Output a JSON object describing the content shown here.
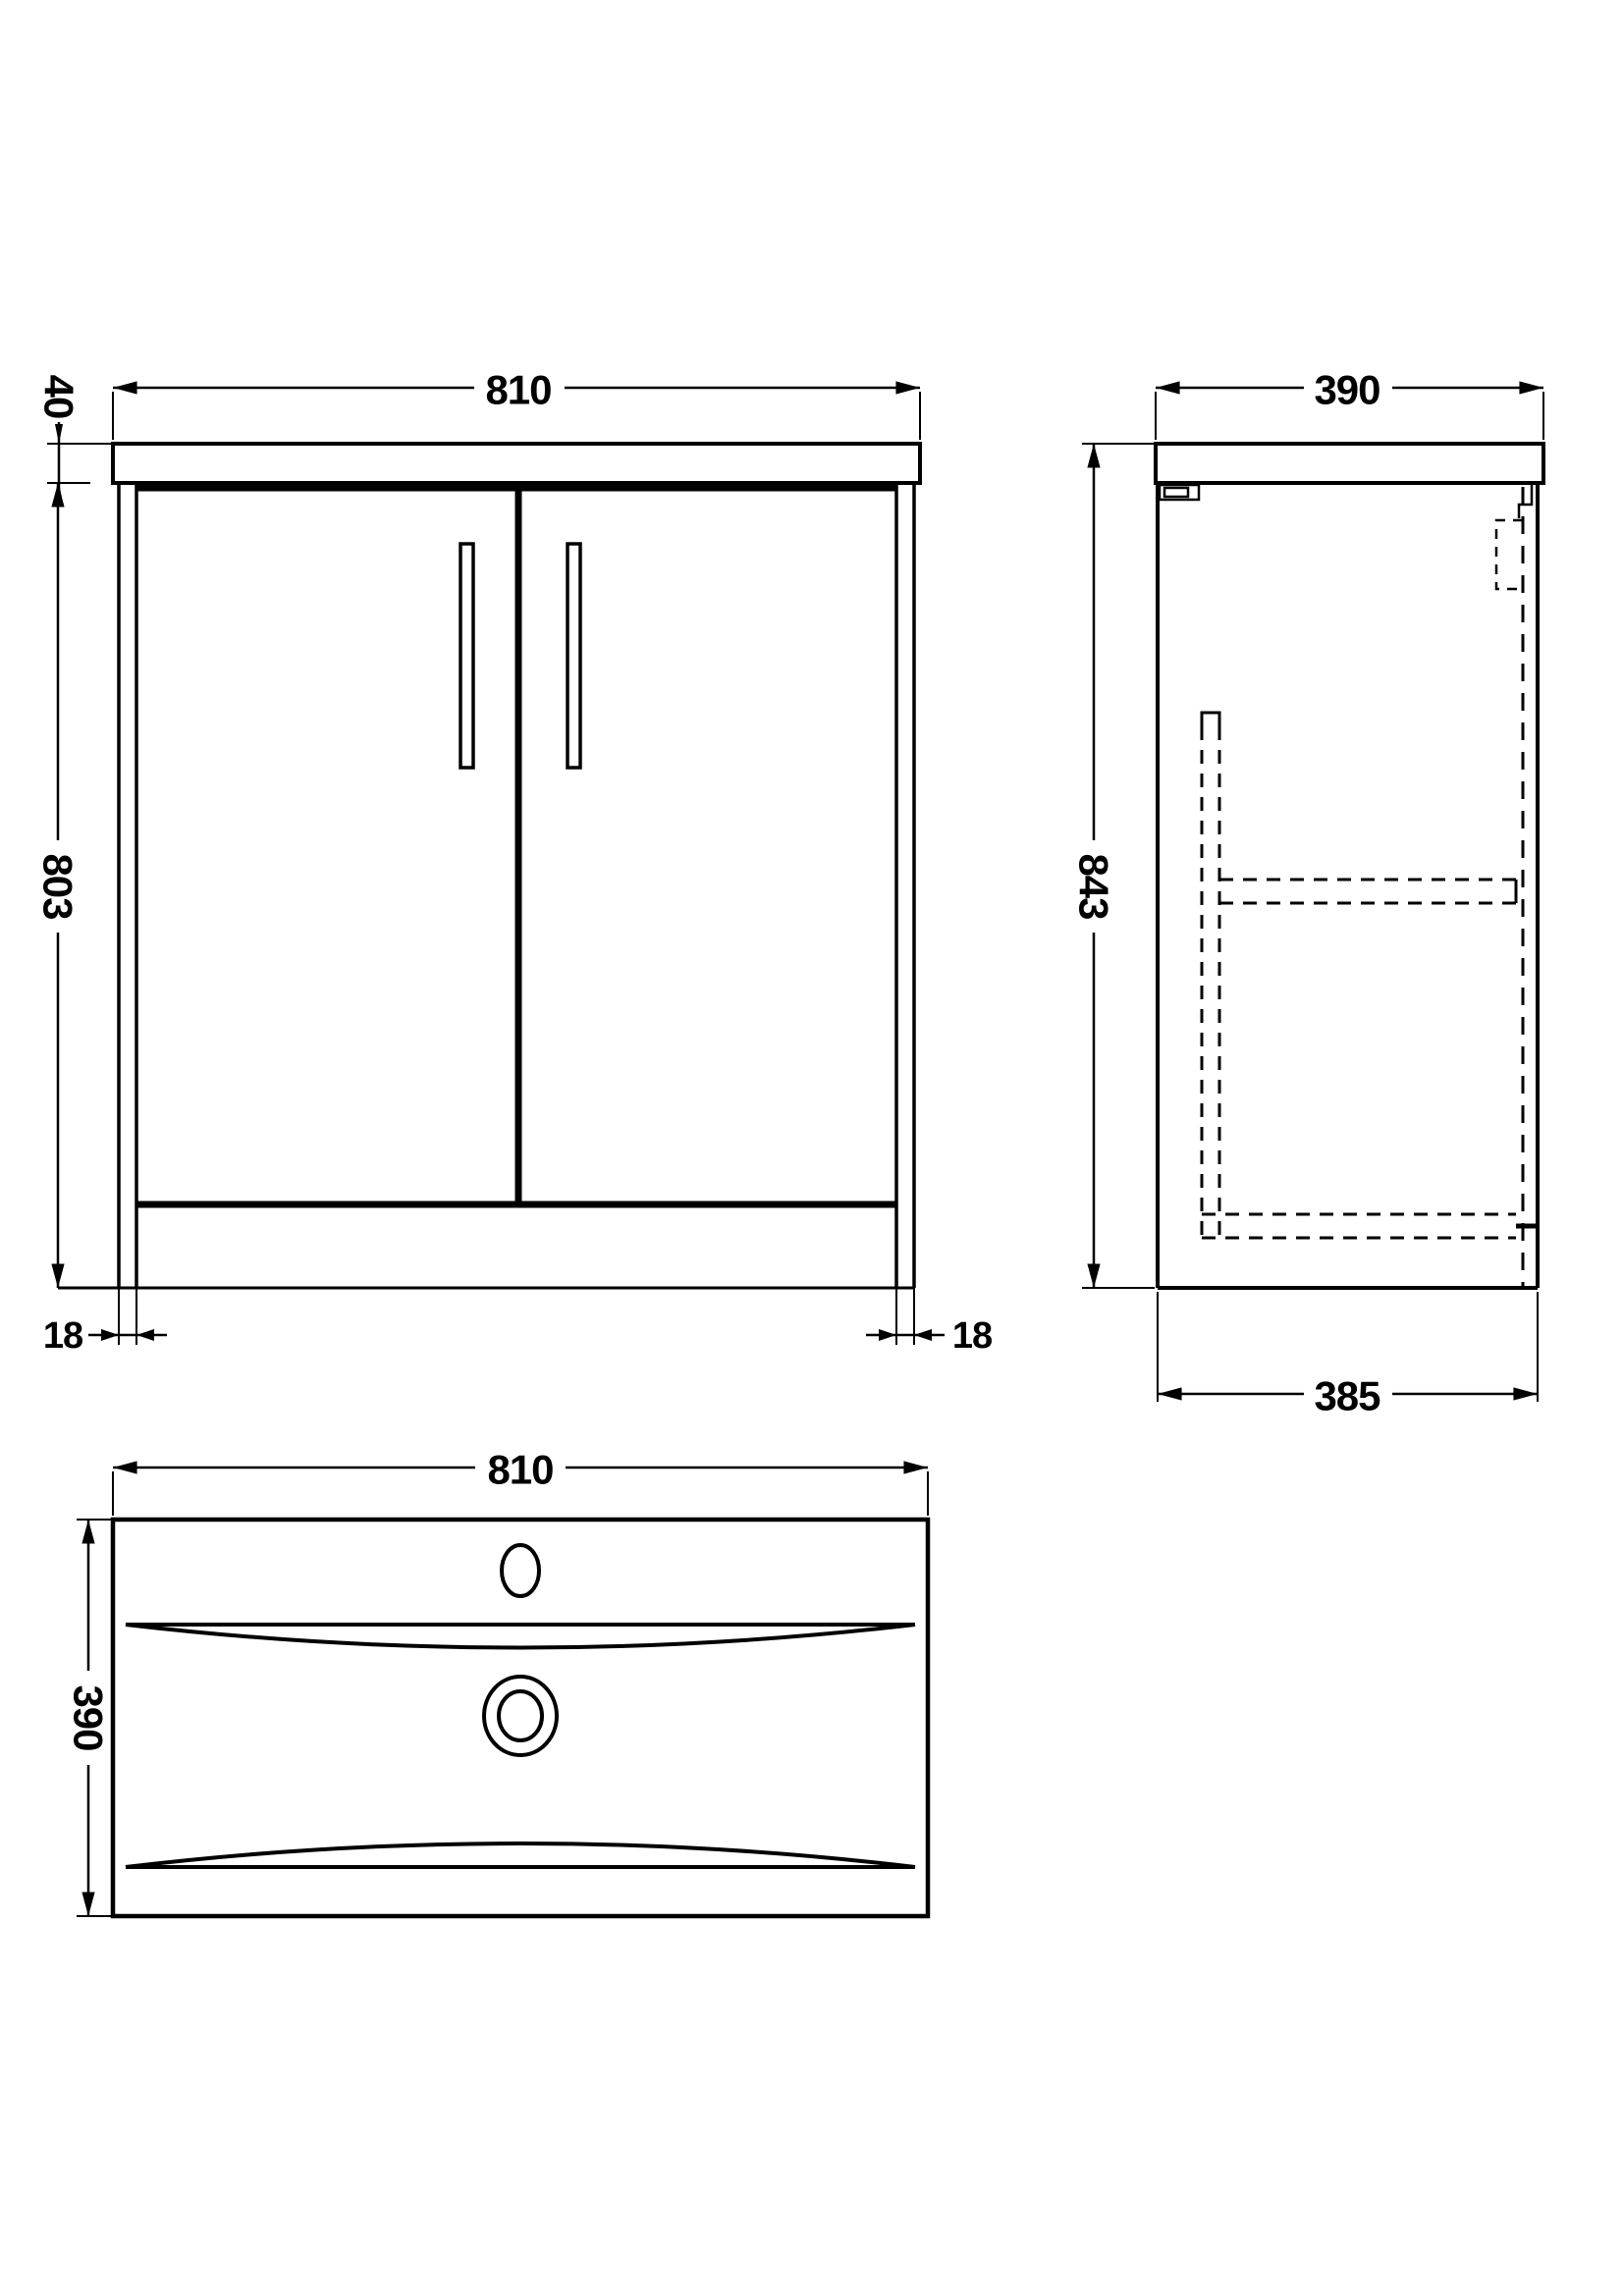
{
  "sheet": {
    "background_color": "#ffffff",
    "line_color": "#000000",
    "drawing_type": "vanity-unit-technical-drawing"
  },
  "views": {
    "front_elevation": {
      "dimensions": {
        "overall_width_mm": "810",
        "worktop_thickness_mm": "40",
        "cabinet_height_mm": "803",
        "left_panel_thickness_mm": "18",
        "right_panel_thickness_mm": "18"
      }
    },
    "side_elevation": {
      "dimensions": {
        "overall_depth_mm": "390",
        "overall_height_mm": "843",
        "cabinet_depth_mm": "385"
      }
    },
    "basin_plan": {
      "dimensions": {
        "width_mm": "810",
        "depth_mm": "390"
      }
    }
  }
}
